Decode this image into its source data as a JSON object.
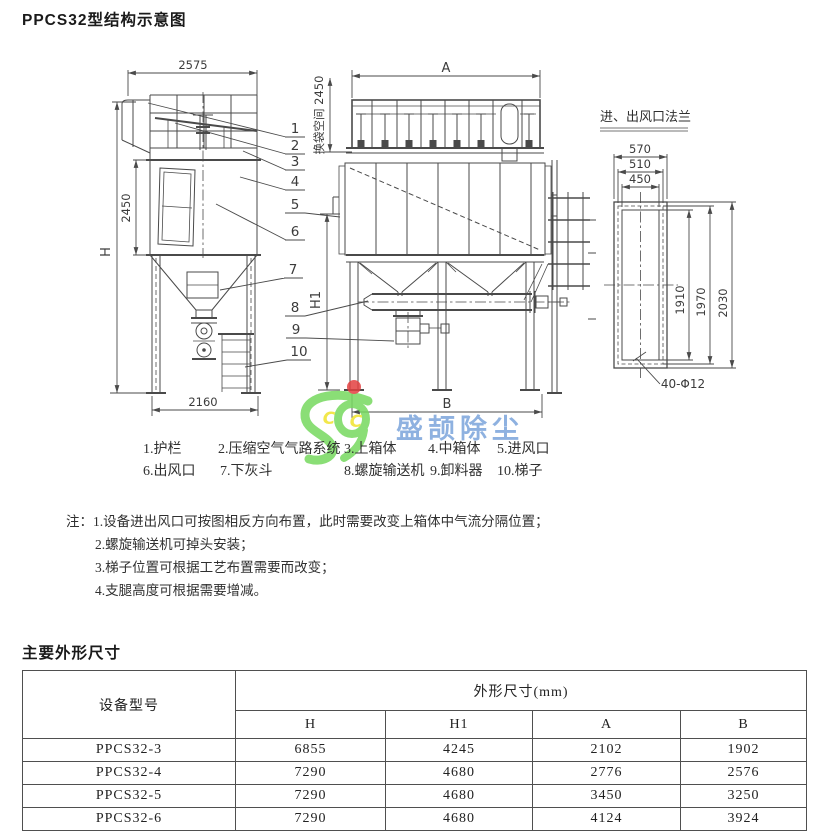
{
  "page": {
    "title": "PPCS32型结构示意图",
    "section2_title": "主要外形尺寸"
  },
  "diagram": {
    "side_view": {
      "width_top": "2575",
      "height_mid": "2450",
      "height_total": "H",
      "base_width": "2160"
    },
    "bag_space": "换袋空间 2450",
    "front_view": {
      "width_top": "A",
      "height_leg": "H1",
      "base_width": "B"
    },
    "callouts": [
      "1",
      "2",
      "3",
      "4",
      "5",
      "6",
      "7",
      "8",
      "9",
      "10"
    ],
    "flange": {
      "title": "进、出风口法兰",
      "w_outer": "570",
      "w_bolt": "510",
      "w_inner": "450",
      "h_inner": "1910",
      "h_bolt": "1970",
      "h_outer": "2030",
      "holes": "40-Φ12"
    }
  },
  "legend": {
    "row1": [
      {
        "label": "1.护栏"
      },
      {
        "label": "2.压缩空气气路系统"
      },
      {
        "label": "3.上箱体"
      },
      {
        "label": "4.中箱体"
      },
      {
        "label": "5.进风口"
      }
    ],
    "row2": [
      {
        "label": "6.出风口"
      },
      {
        "label": "7.下灰斗"
      },
      {
        "label": "8.螺旋输送机"
      },
      {
        "label": "9.卸料器"
      },
      {
        "label": "10.梯子"
      }
    ]
  },
  "notes": {
    "prefix": "注：",
    "items": [
      "1.设备进出风口可按图相反方向布置，此时需要改变上箱体中气流分隔位置；",
      "2.螺旋输送机可掉头安装；",
      "3.梯子位置可根据工艺布置需要而改变；",
      "4.支腿高度可根据需要增减。"
    ]
  },
  "watermark": {
    "initials": [
      "C",
      "C"
    ],
    "text": "盛颉除尘",
    "colors": {
      "green": "#76d95f",
      "blue": "#5a8ed2",
      "yellow": "#f0e32c",
      "red": "#e34040"
    }
  },
  "table": {
    "col0_header": "设备型号",
    "group_header": "外形尺寸(mm)",
    "sub_headers": [
      "H",
      "H1",
      "A",
      "B"
    ],
    "rows": [
      {
        "model": "PPCS32-3",
        "h": "6855",
        "h1": "4245",
        "a": "2102",
        "b": "1902"
      },
      {
        "model": "PPCS32-4",
        "h": "7290",
        "h1": "4680",
        "a": "2776",
        "b": "2576"
      },
      {
        "model": "PPCS32-5",
        "h": "7290",
        "h1": "4680",
        "a": "3450",
        "b": "3250"
      },
      {
        "model": "PPCS32-6",
        "h": "7290",
        "h1": "4680",
        "a": "4124",
        "b": "3924"
      }
    ]
  }
}
